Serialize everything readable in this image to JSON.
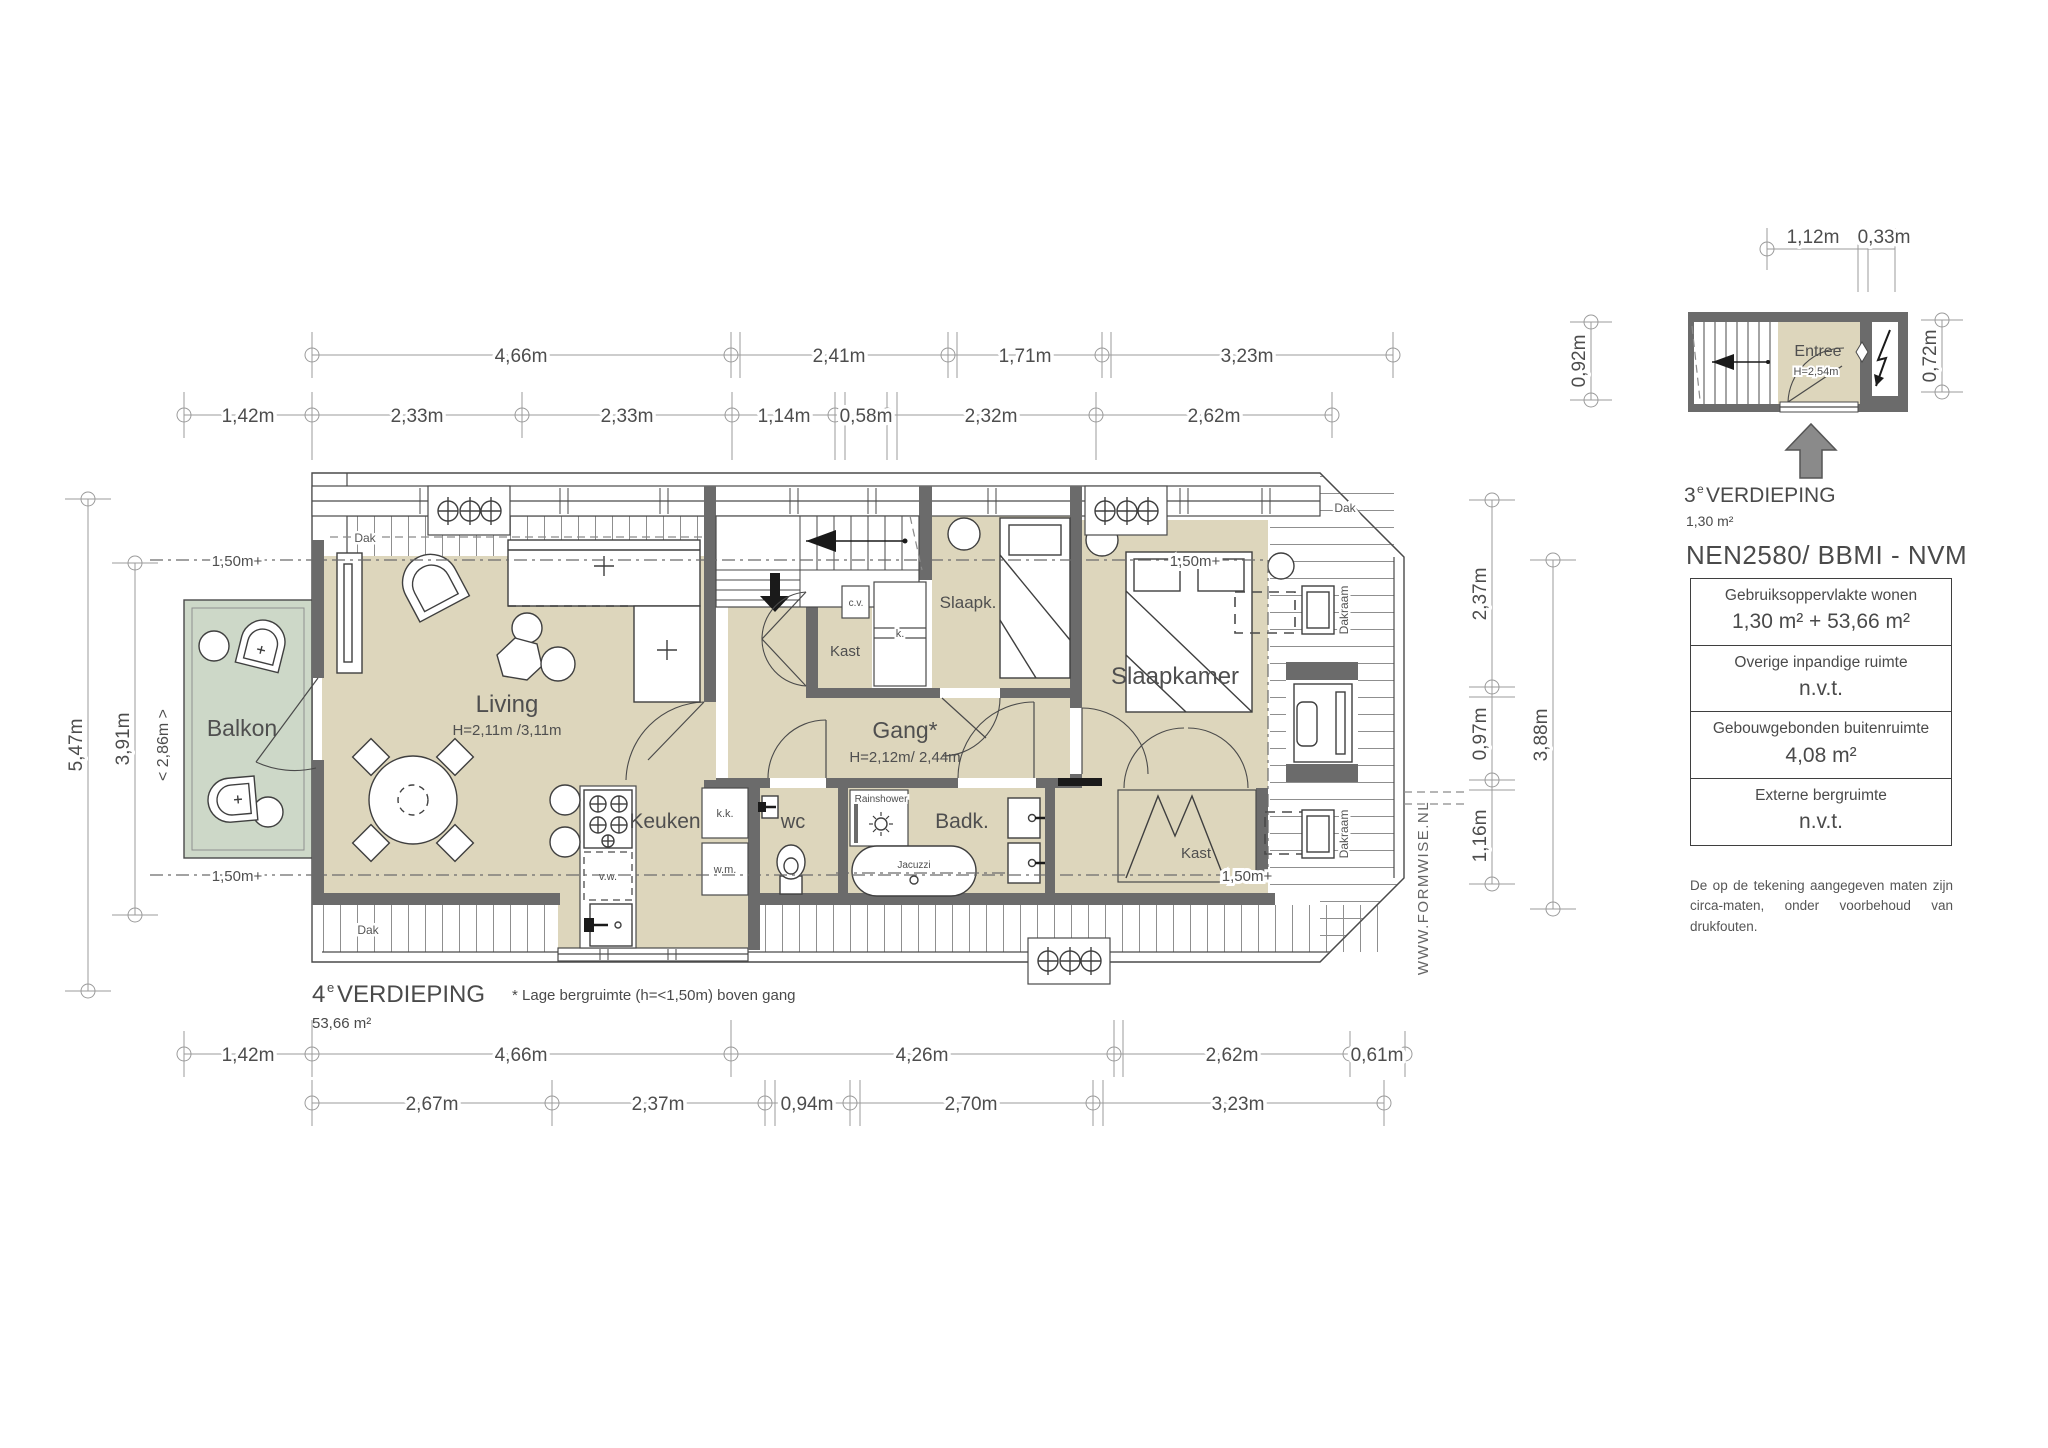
{
  "plan4": {
    "title_num": "4",
    "title_sup": "e",
    "title_word": "VERDIEPING",
    "area": "53,66 m²",
    "footnote": "* Lage bergruimte (h=<1,50m) boven gang"
  },
  "plan3": {
    "title_num": "3",
    "title_sup": "e",
    "title_word": "VERDIEPING",
    "area": "1,30 m²"
  },
  "rooms": {
    "balkon": "Balkon",
    "living": "Living",
    "living_h": "H=2,11m /3,11m",
    "keuken": "Keuken",
    "wc": "wc",
    "badk": "Badk.",
    "gang": "Gang*",
    "gang_h": "H=2,12m/ 2,44m",
    "slaapk": "Slaapk.",
    "slaapkamer": "Slaapkamer",
    "kast": "Kast",
    "entree": "Entree",
    "entree_h": "H=2,54m"
  },
  "fixtures": {
    "dak": "Dak",
    "dakraam": "Dakraam",
    "cv": "c.v.",
    "k": "k.",
    "kk": "k.k.",
    "wm": "w.m.",
    "vw": "v.w.",
    "rainshower": "Rainshower",
    "jacuzzi": "Jacuzzi",
    "clearance": "1,50m+"
  },
  "dims": {
    "top1": [
      "4,66m",
      "2,41m",
      "1,71m",
      "3,23m"
    ],
    "top2": [
      "1,42m",
      "2,33m",
      "2,33m",
      "1,14m",
      "0,58m",
      "2,32m",
      "2,62m"
    ],
    "left": [
      "5,47m",
      "3,91m"
    ],
    "balkon_width": "< 2,86m >",
    "right_inner": [
      "2,37m",
      "0,97m",
      "1,16m"
    ],
    "right_outer": "3,88m",
    "bottom1": [
      "1,42m",
      "4,66m",
      "4,26m",
      "2,62m",
      "0,61m"
    ],
    "bottom2": [
      "2,67m",
      "2,37m",
      "0,94m",
      "2,70m",
      "3,23m"
    ],
    "mini_top": [
      "1,12m",
      "0,33m"
    ],
    "mini_left": "0,92m",
    "mini_right": "0,72m"
  },
  "legend": {
    "standard": "NEN2580/ BBMI - NVM",
    "rows": [
      {
        "label": "Gebruiksoppervlakte wonen",
        "value": "1,30 m² + 53,66 m²"
      },
      {
        "label": "Overige inpandige ruimte",
        "value": "n.v.t."
      },
      {
        "label": "Gebouwgebonden buitenruimte",
        "value": "4,08 m²"
      },
      {
        "label": "Externe bergruimte",
        "value": "n.v.t."
      }
    ],
    "disclaimer": "De op de tekening aangegeven maten zijn circa-maten, onder voorbehoud van drukfouten."
  },
  "watermark": "WWW.FORMWISE.NL",
  "colors": {
    "room_fill": "#ddd6bc",
    "balcony_fill": "#cdd8c8",
    "wall": "#6b6b6b",
    "dim_line": "#9b9b9b",
    "text": "#4f4f4f"
  }
}
